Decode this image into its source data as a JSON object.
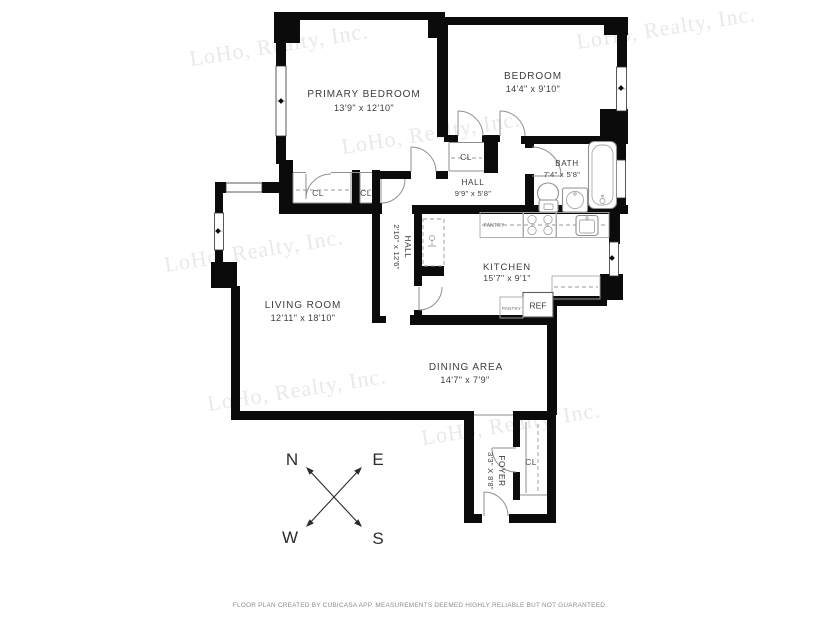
{
  "watermark": {
    "text": "LoHo, Realty, Inc."
  },
  "rooms": {
    "primary_bedroom": {
      "name": "PRIMARY BEDROOM",
      "dims": "13'9\" x 12'10\""
    },
    "bedroom": {
      "name": "BEDROOM",
      "dims": "14'4\" x 9'10\""
    },
    "bath": {
      "name": "BATH",
      "dims": "7'4\" x 5'8\""
    },
    "hall": {
      "name": "HALL",
      "dims": "9'9\" x 5'8\""
    },
    "hall_vertical": {
      "name": "HALL",
      "dims": "2'10\" x 12'6\""
    },
    "kitchen": {
      "name": "KITCHEN",
      "dims": "15'7\" x 9'1\""
    },
    "living_room": {
      "name": "LIVING ROOM",
      "dims": "12'11\" x 18'10\""
    },
    "dining_area": {
      "name": "DINING AREA",
      "dims": "14'7\" x 7'9\""
    },
    "foyer": {
      "name": "FOYER",
      "dims": "3'3\" X 8'8\""
    }
  },
  "labels": {
    "closet": "CL",
    "pantry": "PANTRY",
    "refrigerator": "REF"
  },
  "compass": {
    "north": "N",
    "east": "E",
    "west": "W",
    "south": "S"
  },
  "footer": "FLOOR PLAN CREATED BY CUBICASA APP. MEASUREMENTS DEEMED HIGHLY RELIABLE BUT NOT GUARANTEED.",
  "colors": {
    "wall": "#0b0b0b",
    "watermark": "#e9e9e9",
    "label": "#3d3d3d"
  }
}
